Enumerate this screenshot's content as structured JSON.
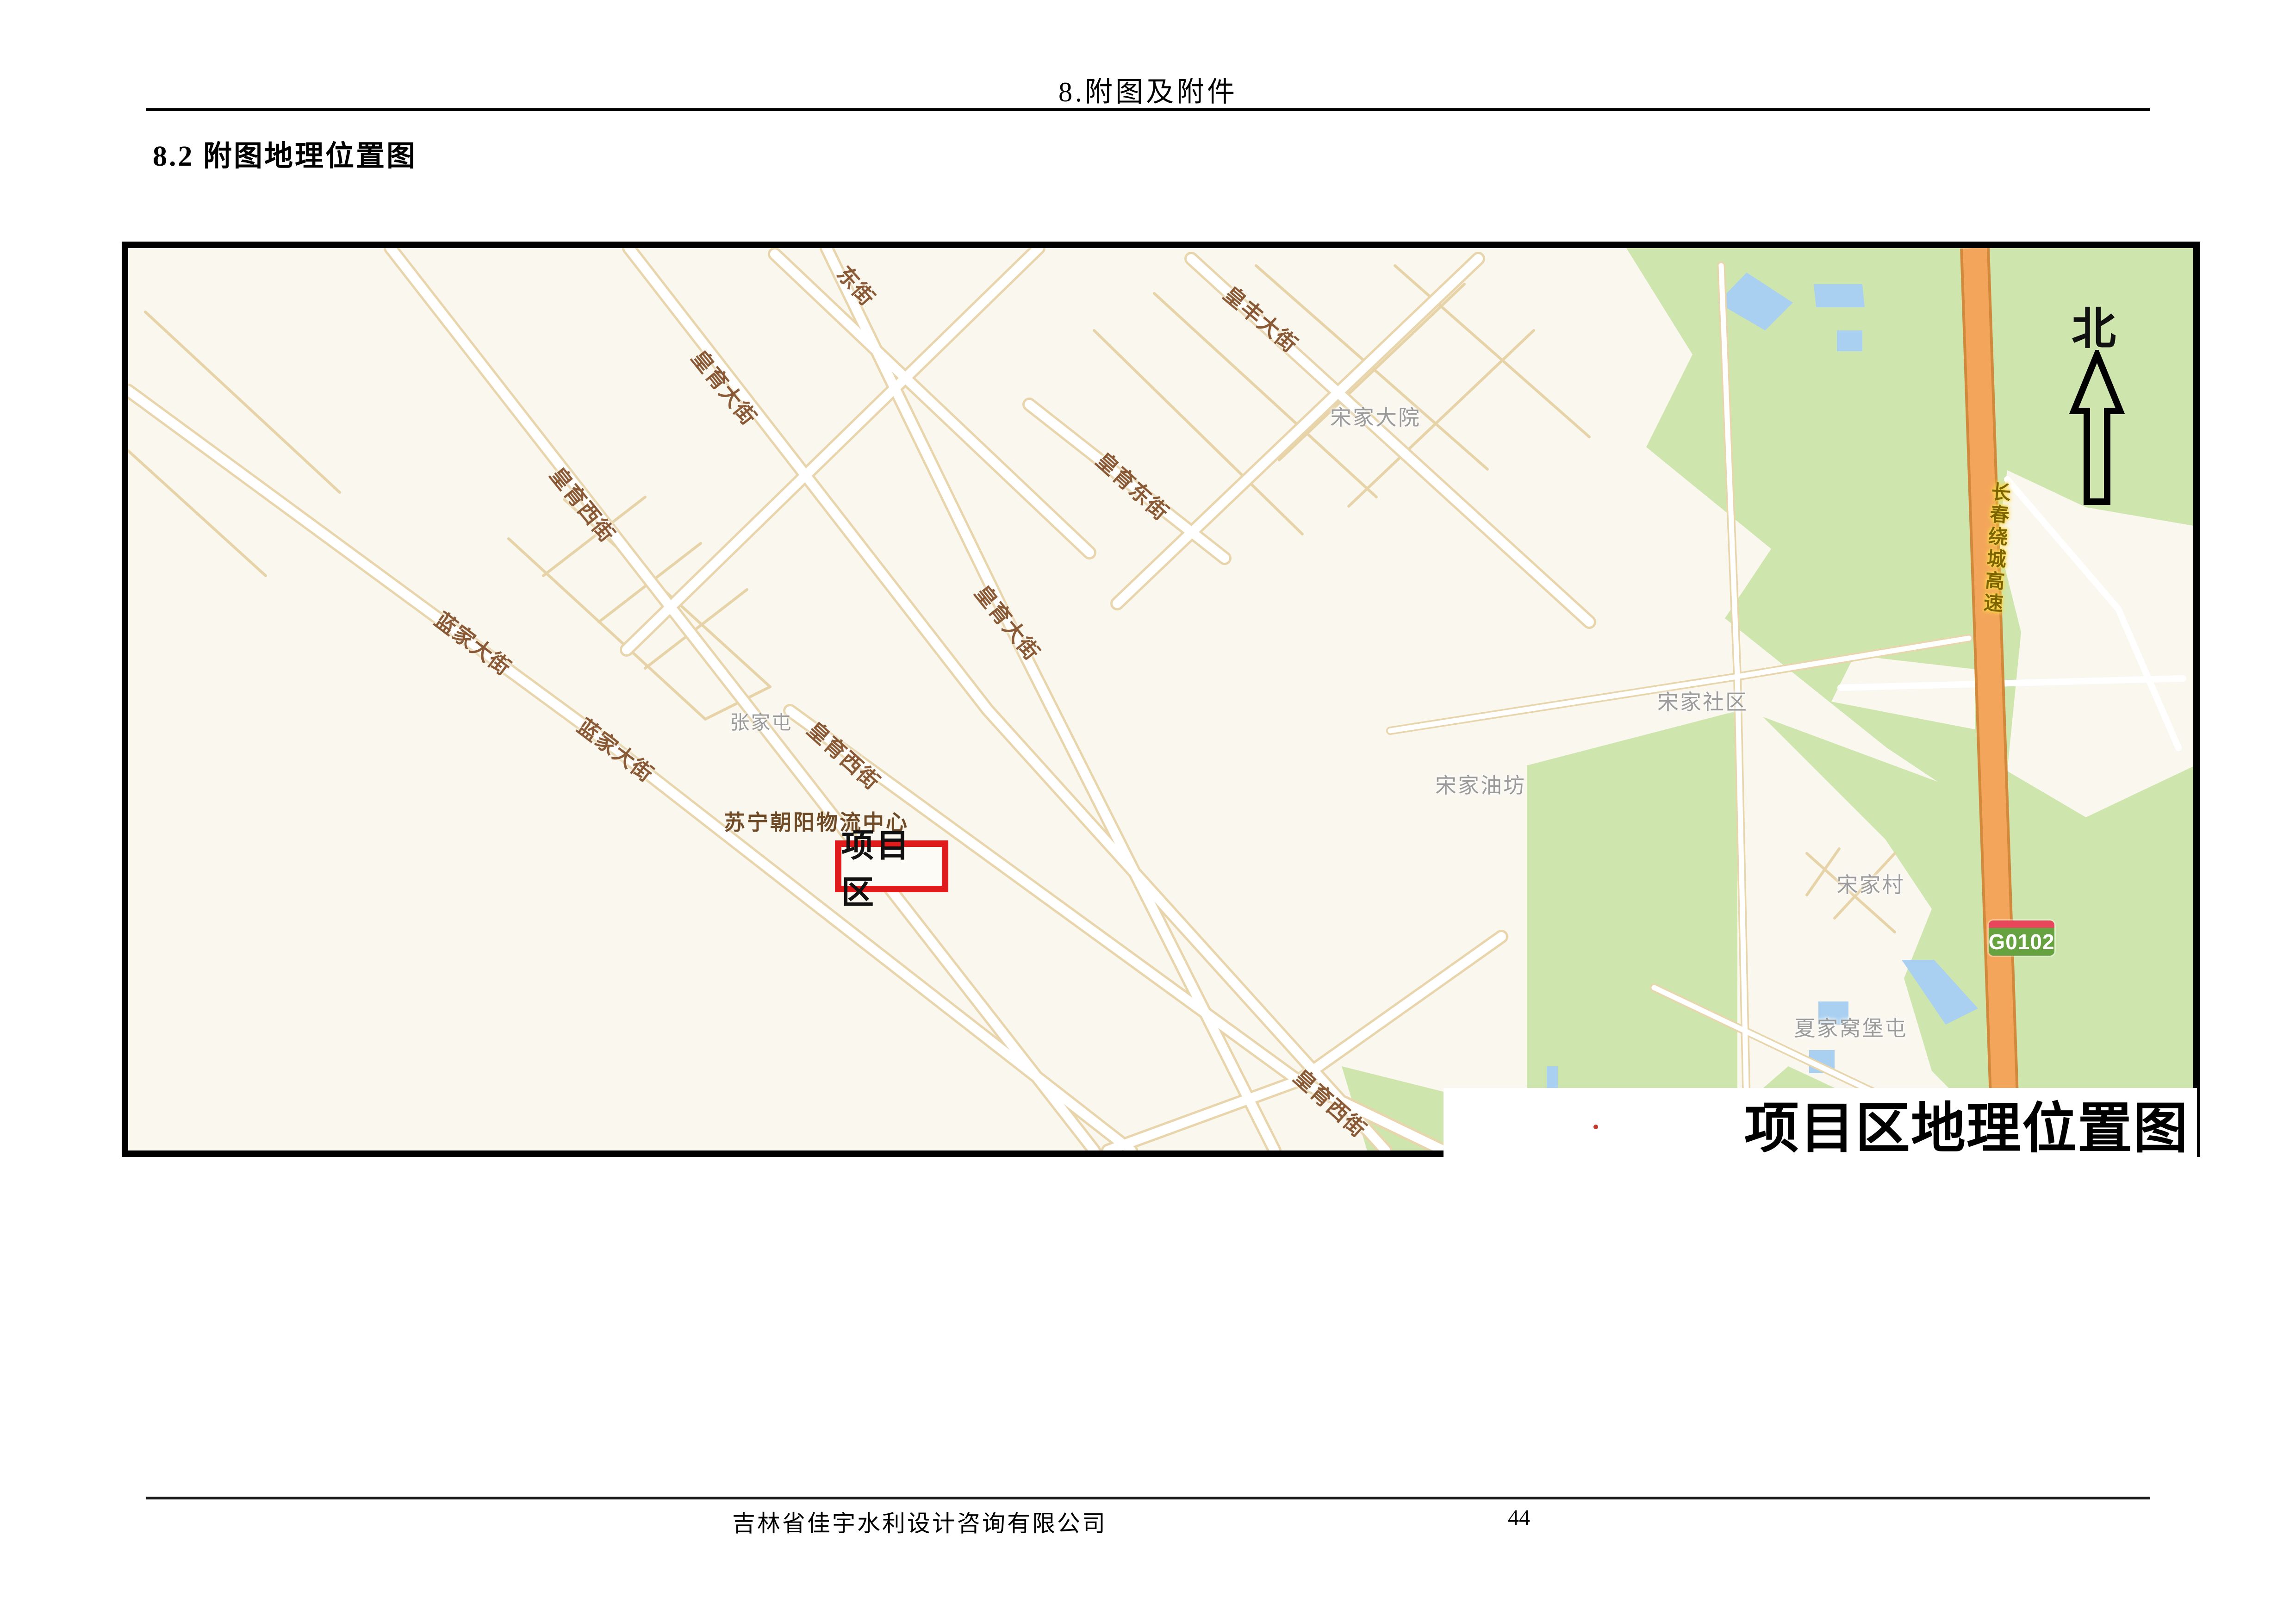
{
  "page": {
    "header": "8.附图及附件",
    "section_heading": "8.2 附图地理位置图",
    "footer_company": "吉林省佳宇水利设计咨询有限公司",
    "page_number": "44"
  },
  "map": {
    "title": "项目区地理位置图",
    "north_label": "北",
    "project_area_label": "项目区",
    "poi_bold_label": "苏宁朝阳物流中心",
    "highway_name": "长春绕城高速",
    "road_badge": "G0102",
    "street_labels": [
      {
        "text": "东街"
      },
      {
        "text": "皇丰大街"
      },
      {
        "text": "皇育大街"
      },
      {
        "text": "皇育西街"
      },
      {
        "text": "皇育东街"
      },
      {
        "text": "皇育大街"
      },
      {
        "text": "蓝家大街"
      },
      {
        "text": "蓝家大街"
      },
      {
        "text": "皇育西街"
      },
      {
        "text": "皇育西街"
      }
    ],
    "place_labels": [
      {
        "text": "张家屯"
      },
      {
        "text": "宋家大院"
      },
      {
        "text": "宋家社区"
      },
      {
        "text": "宋家油坊"
      },
      {
        "text": "宋家村"
      },
      {
        "text": "夏家窝堡屯"
      }
    ],
    "colors": {
      "land": "#faf7ef",
      "green_area": "#cfe5ae",
      "water": "#a9d0f1",
      "highway_fill": "#f3a65b",
      "highway_casing": "#d2893b",
      "road_casing": "#e8d5ac",
      "badge_green": "#66a23f",
      "badge_red": "#e8465a",
      "street_label_color": "#8a5a36",
      "place_label_color": "#9b9b9b",
      "project_box_red": "#e01b1b"
    }
  }
}
